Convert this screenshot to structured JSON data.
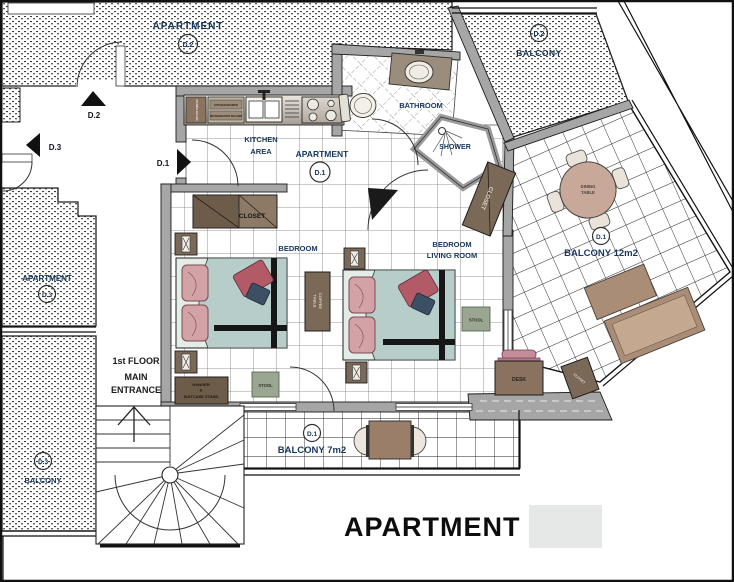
{
  "title": "APARTMENT 1",
  "units": {
    "apartment_d2": {
      "label": "APARTMENT",
      "id": "D.2"
    },
    "balcony_d2": {
      "id": "D.2",
      "label": "BALCONY"
    },
    "apartment_d3": {
      "label": "APARTMENT",
      "id": "D.3"
    },
    "balcony_d3": {
      "id": "D.3",
      "label": "BALCONY"
    },
    "apartment_d1": {
      "label": "APARTMENT",
      "id": "D.1"
    }
  },
  "doors": {
    "d2": "D.2",
    "d3": "D.3",
    "d1": "D.1"
  },
  "rooms": {
    "kitchen": {
      "line1": "KITCHEN",
      "line2": "AREA"
    },
    "bathroom": "BATHROOM",
    "shower": "SHOWER",
    "bedroom": "BEDROOM",
    "bedroom_living": {
      "line1": "BEDROOM",
      "line2": "LIVING ROOM"
    },
    "entrance": {
      "line1": "1st FLOOR",
      "line2": "MAIN",
      "line3": "ENTRANCE"
    },
    "balcony_12": {
      "id": "D.1",
      "label": "BALCONY 12m2"
    },
    "balcony_7": {
      "id": "D.1",
      "label": "BALCONY 7m2"
    }
  },
  "furniture": {
    "closet_bedroom": "CLOSET",
    "closet_entry": "CLOSET",
    "closet_desk": "CLOSET",
    "coffee_table": {
      "line1": "COFFEE",
      "line2": "TABLE"
    },
    "dining_table": {
      "line1": "DINING",
      "line2": "TABLE"
    },
    "stool_bedroom": "STOOL",
    "stool_living": "STOOL",
    "desk": "DESK",
    "hanger_stand": {
      "line1": "HANGER",
      "line2": "&",
      "line3": "SUITCASE STAND"
    },
    "cabinet_ironing": "IRONING BOARD",
    "cabinet_row1": "KITCHEN DRAWER",
    "cabinet_row2": "REFRIGERATOR WASHER"
  },
  "colors": {
    "wall_gray": "#a6a6a6",
    "label_navy": "#17365d",
    "door_black": "#111111",
    "furniture_brown": "#7b6958",
    "bed_blanket_teal": "#b7cdca",
    "pillow_pink": "#d3a2a6",
    "throw_pillow_red": "#b25a66",
    "throw_pillow_navy": "#3c4f63",
    "stool_olive": "#9aa691",
    "chair_pink": "#c58d9b",
    "dining_table_tan": "#c8a999",
    "swatch_gray": "#e6e8e8"
  }
}
